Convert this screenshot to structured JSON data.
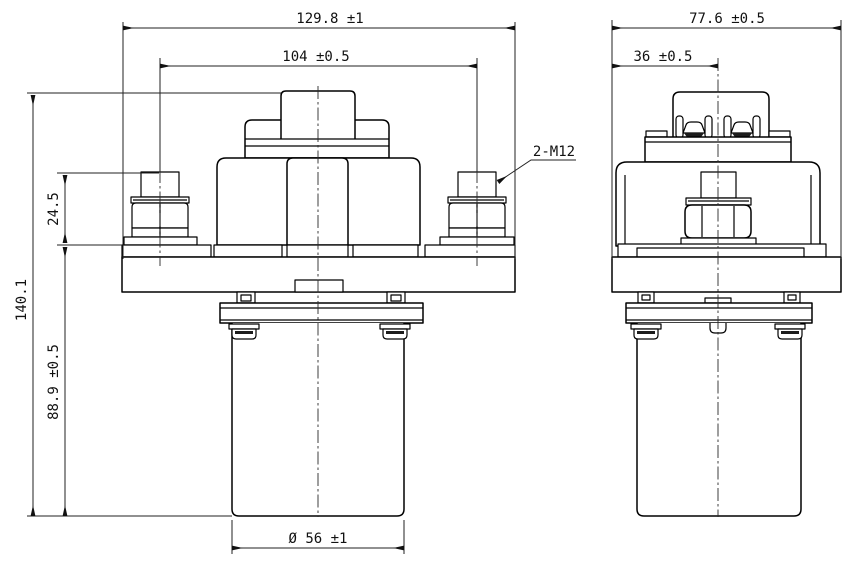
{
  "front_view": {
    "dim_overall_width": "129.8 ±1",
    "dim_stud_spacing": "104 ±0.5",
    "dim_stud_height": "24.5",
    "dim_overall_height": "140.1",
    "dim_body_height": "88.9 ±0.5",
    "dim_cylinder_diameter": "Ø 56 ±1",
    "label_stud_thread": "2-M12"
  },
  "side_view": {
    "dim_overall_depth": "77.6 ±0.5",
    "dim_center_offset": "36 ±0.5"
  }
}
